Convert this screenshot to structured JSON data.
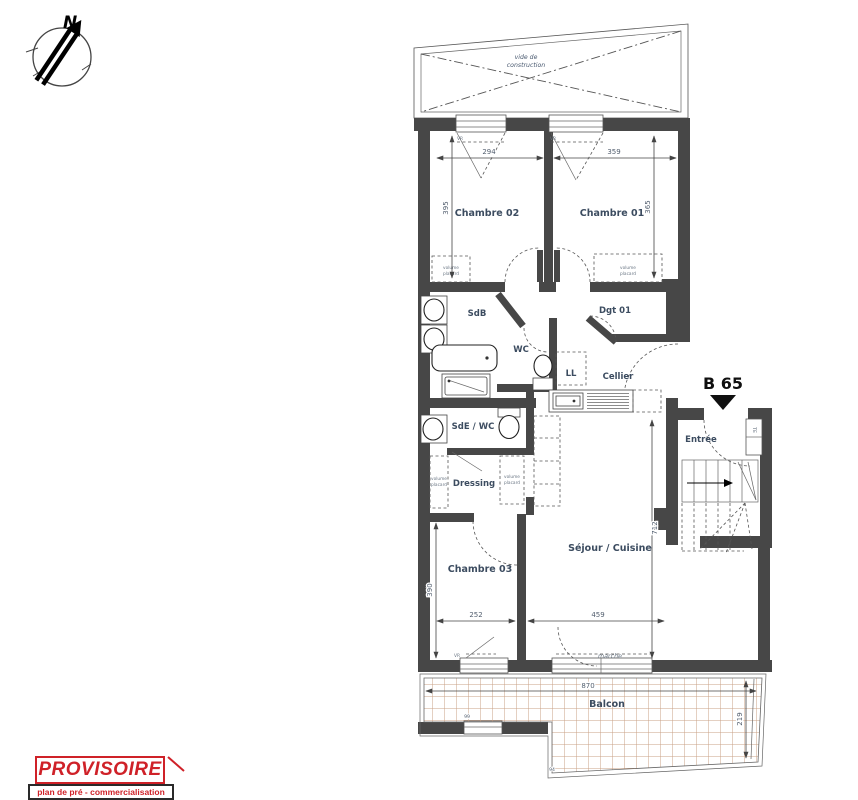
{
  "compass": {
    "north_label": "N"
  },
  "plan": {
    "unit_label": "B 65",
    "void_line1": "vide de",
    "void_line2": "construction",
    "rooms": {
      "chambre01": "Chambre 01",
      "chambre02": "Chambre 02",
      "chambre03": "Chambre 03",
      "sdb": "SdB",
      "wc": "WC",
      "dgt": "Dgt 01",
      "cellier": "Cellier",
      "sde_wc": "SdE / WC",
      "dressing": "Dressing",
      "sejour": "Séjour / Cuisine",
      "entree": "Entrée",
      "balcon": "Balcon"
    },
    "appliances": {
      "washer": "LL",
      "electrical": "TE"
    },
    "annotations": {
      "marche": "marche",
      "vr": "VR",
      "volume": "volume",
      "placard": "placard"
    },
    "dimensions": {
      "d294": "294",
      "d359": "359",
      "d395": "395",
      "d365": "365",
      "d252": "252",
      "d459": "459",
      "d390": "390",
      "d712": "712",
      "d870": "870",
      "d219": "219",
      "d99": "99",
      "d94": "94"
    }
  },
  "stamp": {
    "title": "PROVISOIRE",
    "subtitle": "plan de pré - commercialisation"
  },
  "colors": {
    "wall": "#474747",
    "stamp_red": "#cf2128",
    "label_blue": "#3c4c60",
    "tile_tan": "#c9a185"
  }
}
